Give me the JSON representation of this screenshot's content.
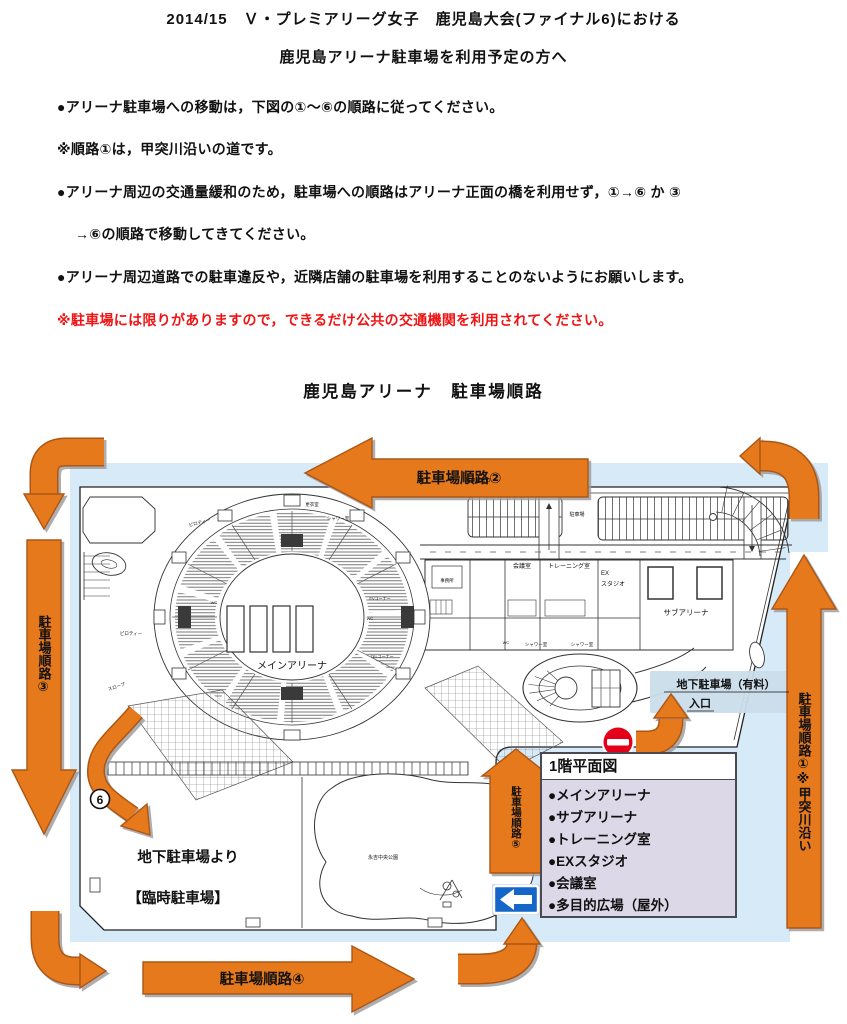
{
  "doc": {
    "title1": "2014/15　Ｖ・プレミアリーグ女子　鹿児島大会(ファイナル6)における",
    "title2": "鹿児島アリーナ駐車場を利用予定の方へ",
    "b1": "●アリーナ駐車場への移動は，下図の①～⑥の順路に従ってください。",
    "b2": "※順路①は，甲突川沿いの道です。",
    "b3": "●アリーナ周辺の交通量緩和のため，駐車場への順路はアリーナ正面の橋を利用せず，①→⑥ か ③",
    "b4": "→⑥の順路で移動してきてください。",
    "b5": "●アリーナ周辺道路での駐車違反や，近隣店舗の駐車場を利用することのないようにお願いします。",
    "warning": "※駐車場には限りがありますので，できるだけ公共の交通機関を利用されてください。",
    "map_title": "鹿児島アリーナ　駐車場順路"
  },
  "map": {
    "routes": {
      "r1": "駐車場順路①※甲突川沿い",
      "r2": "駐車場順路②",
      "r3": "駐車場順路③",
      "r4": "駐車場順路④",
      "r5": "駐車場順路⑤",
      "r6_badge": "6"
    },
    "legend": {
      "title": "1階平面図",
      "items": [
        "●メインアリーナ",
        "●サブアリーナ",
        "●トレーニング室",
        "●EXスタジオ",
        "●会議室",
        "●多目的広場（屋外）"
      ]
    },
    "labels": {
      "main_arena": "メインアリーナ",
      "sub_arena": "サブアリーナ",
      "training": "トレーニング室",
      "meeting": "会議室",
      "ex1": "EX",
      "ex2": "スタジオ",
      "parking_lot": "駐車場",
      "parking_exit": "駐車場出口",
      "ug1": "地下駐車場（有料）",
      "ug2": "入口",
      "from_ug": "地下駐車場より",
      "temp_parking": "【臨時駐車場】",
      "park": "永吉中央公園",
      "piloti": "ピロティー",
      "shower": "シャワー室",
      "wc": "WC",
      "ev": "EVコーナー",
      "tel": "TELコーナー",
      "slope": "スロープ",
      "locker": "更衣室",
      "office": "事務所"
    },
    "colors": {
      "arrow": "#E5791E",
      "arrow_border": "#AC5712",
      "bg_blue": "#D7EAF7",
      "legend_bg": "#DCD8E8",
      "no_entry_red": "#E50019",
      "sign_blue": "#1466C8",
      "warning_red": "#F01414"
    }
  }
}
